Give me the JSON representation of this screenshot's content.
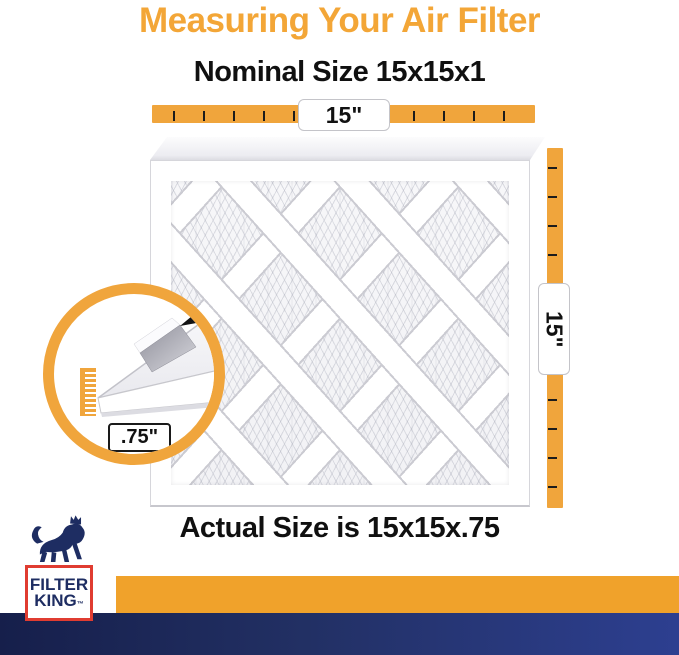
{
  "page": {
    "title": "Measuring Your Air Filter",
    "subtitle": "Nominal Size 15x15x1",
    "footer": "Actual Size is 15x15x.75"
  },
  "measurements": {
    "width_label": "15\"",
    "height_label": "15\"",
    "depth_label": ".75\""
  },
  "brand": {
    "name_line1": "FILTER",
    "name_line2": "KING",
    "trademark": "™"
  },
  "icons": {
    "horizontal_ruler": "orange ruler bar with tick marks",
    "vertical_ruler": "orange ruler bar with tick marks",
    "magnifier_ring": "orange zoom circle showing filter edge depth",
    "pointer_arrow": "small black arrow pointing at filter edge",
    "lion_logo": "navy crowned lion mascot"
  },
  "colors": {
    "title_orange": "#F3A637",
    "ruler_orange": "#F0A53C",
    "bar_orange": "#F0A22B",
    "navy_dark": "#161F4B",
    "navy_bright": "#2D3F90",
    "logo_navy": "#1E2D62",
    "logo_red": "#E03C31",
    "text_black": "#101010"
  }
}
